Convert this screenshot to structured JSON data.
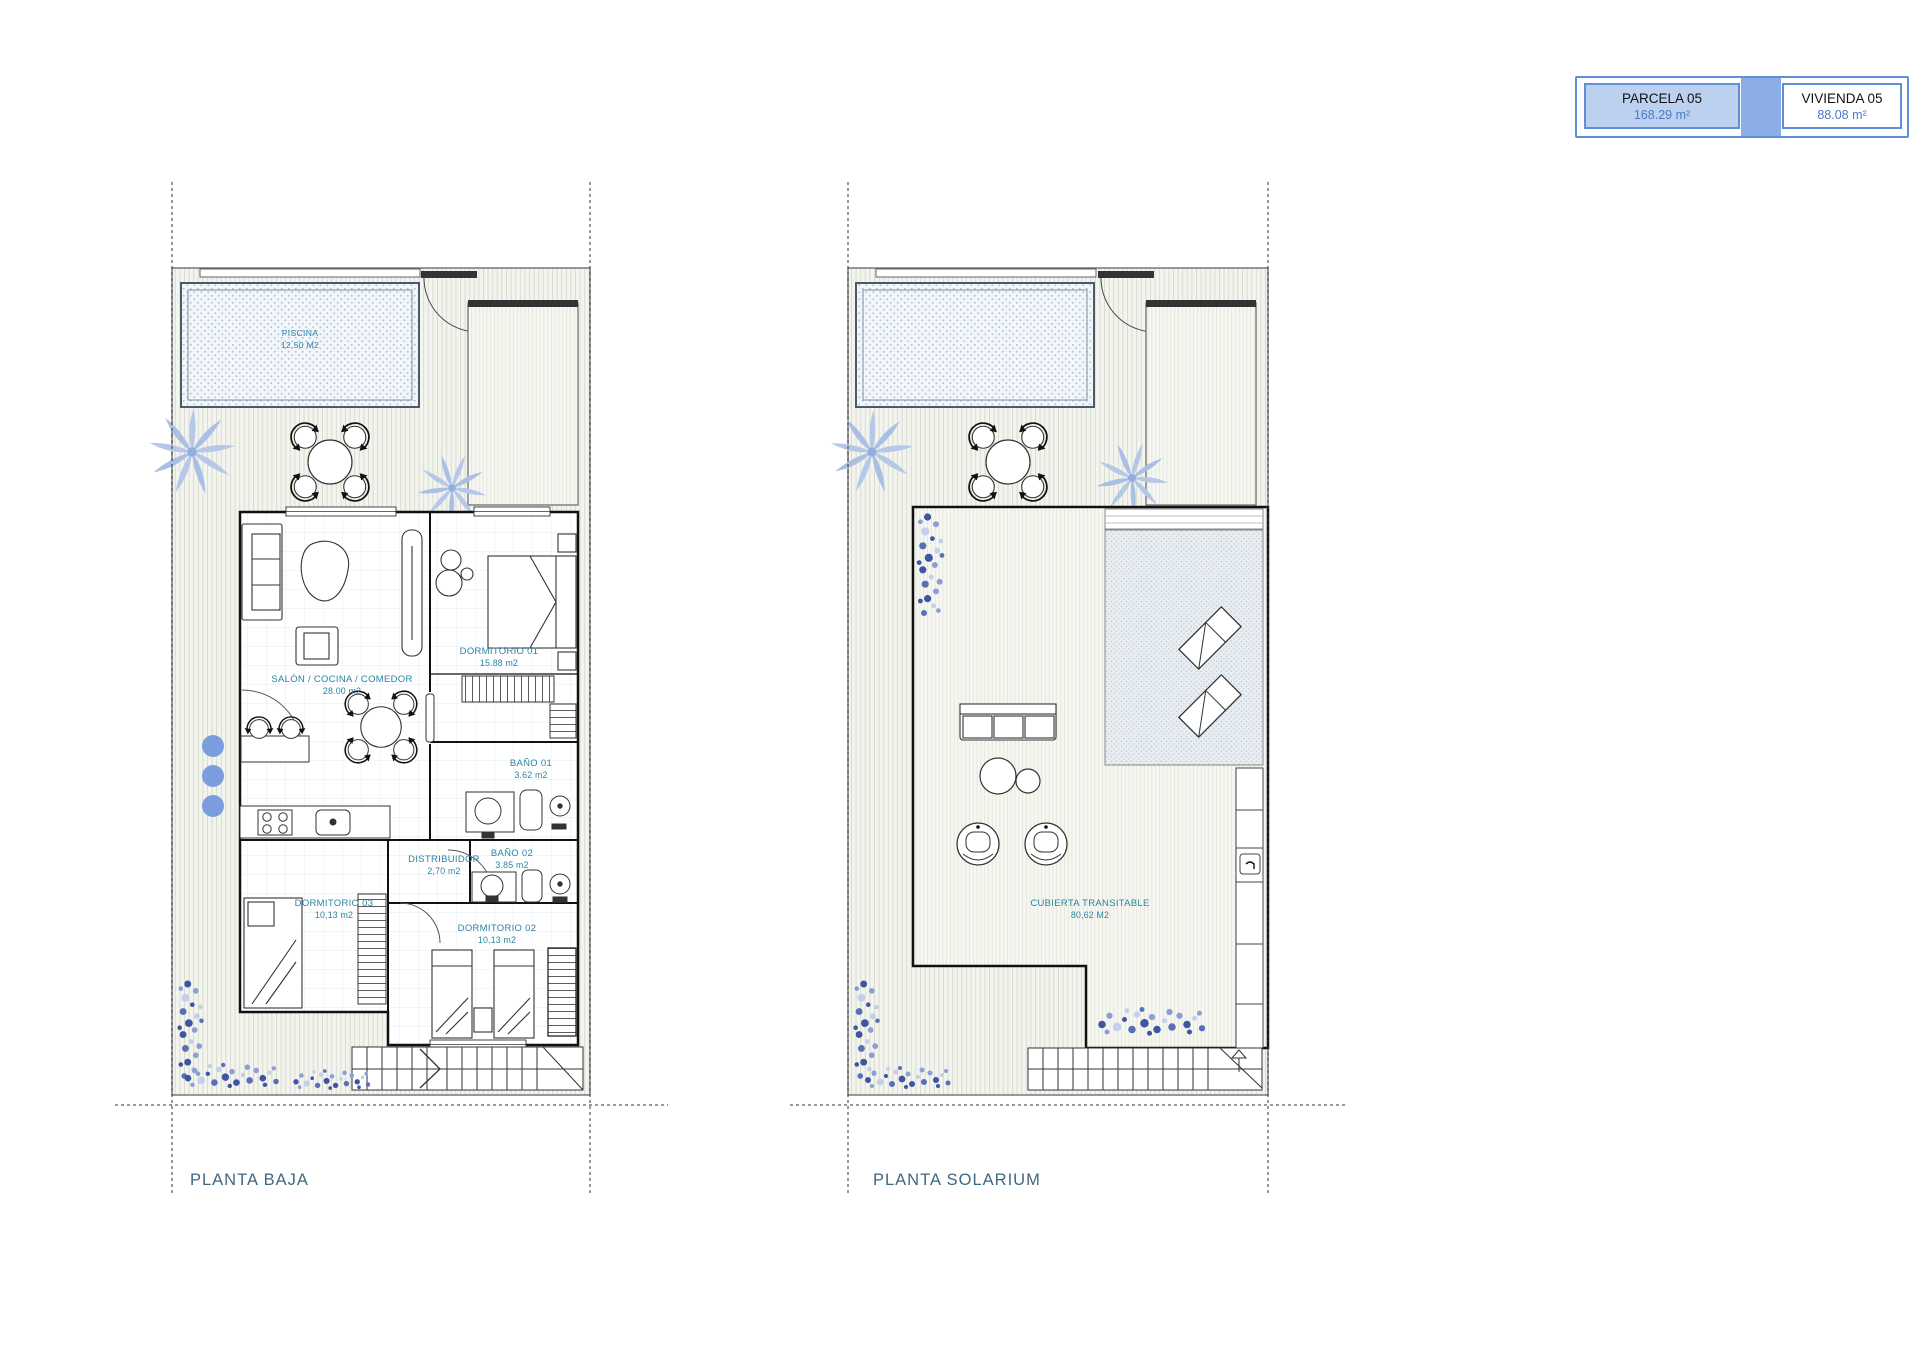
{
  "legend": {
    "parcela": {
      "label": "PARCELA 05",
      "area": "168.29 m²"
    },
    "vivienda": {
      "label": "VIVIENDA 05",
      "area": "88.08 m²"
    }
  },
  "planta_baja": {
    "title": "PLANTA BAJA",
    "pool": {
      "name": "PISCINA",
      "area": "12.50 M2"
    },
    "rooms": [
      {
        "name": "SALÓN / COCINA / COMEDOR",
        "area": "28.00 m2"
      },
      {
        "name": "DORMITORIO 01",
        "area": "15.88 m2"
      },
      {
        "name": "BAÑO 01",
        "area": "3.62 m2"
      },
      {
        "name": "BAÑO 02",
        "area": "3.85 m2"
      },
      {
        "name": "DISTRIBUIDOR",
        "area": "2,70 m2"
      },
      {
        "name": "DORMITORIO 03",
        "area": "10,13 m2"
      },
      {
        "name": "DORMITORIO 02",
        "area": "10,13 m2"
      }
    ]
  },
  "planta_solarium": {
    "title": "PLANTA SOLARIUM",
    "rooms": [
      {
        "name": "CUBIERTA TRANSITABLE",
        "area": "80,62 M2"
      }
    ]
  },
  "colors": {
    "accent_blue": "#4a7bc8",
    "legend_fill": "#bcd0f0",
    "legend_border": "#5f8fd4",
    "room_label_teal": "#2b84a3",
    "title_blue": "#3e6880",
    "plant_blue": "#b5c8e8"
  }
}
